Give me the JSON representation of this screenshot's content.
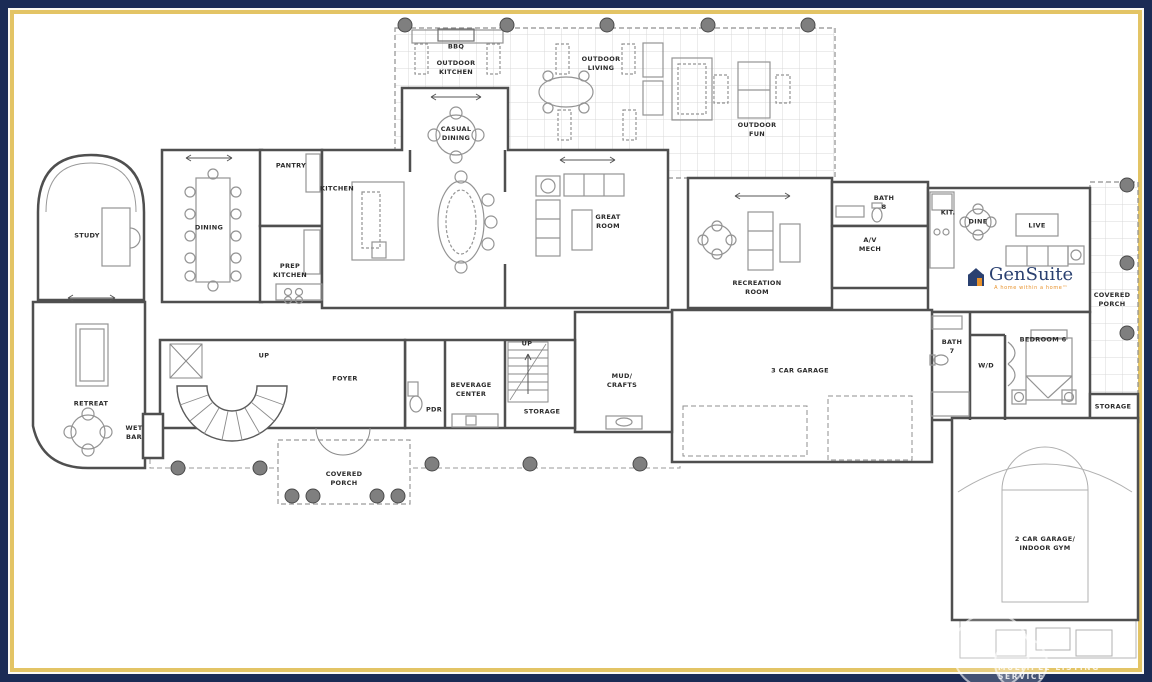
{
  "branding": {
    "logo_text": "GenSuite",
    "logo_tagline": "A home within a home™",
    "watermark": "MULTIPLE LISTING SERVICE"
  },
  "colors": {
    "border_navy": "#1b2c55",
    "border_gold": "#e3c465",
    "wall": "#4f4f4f",
    "furniture": "#949494",
    "logo_blue": "#2a4070",
    "logo_orange": "#e8922c"
  },
  "rooms": [
    {
      "id": "bbq",
      "label": "BBQ",
      "x": 456,
      "y": 47
    },
    {
      "id": "outdoor-kitchen",
      "label": "OUTDOOR\nKITCHEN",
      "x": 456,
      "y": 68
    },
    {
      "id": "outdoor-living",
      "label": "OUTDOOR\nLIVING",
      "x": 601,
      "y": 64
    },
    {
      "id": "outdoor-fun",
      "label": "OUTDOOR\nFUN",
      "x": 757,
      "y": 130
    },
    {
      "id": "casual-dining",
      "label": "CASUAL\nDINING",
      "x": 456,
      "y": 134
    },
    {
      "id": "pantry",
      "label": "PANTRY",
      "x": 291,
      "y": 166
    },
    {
      "id": "kitchen",
      "label": "KITCHEN",
      "x": 337,
      "y": 189
    },
    {
      "id": "dining",
      "label": "DINING",
      "x": 209,
      "y": 228
    },
    {
      "id": "prep-kitchen",
      "label": "PREP\nKITCHEN",
      "x": 290,
      "y": 271
    },
    {
      "id": "study",
      "label": "STUDY",
      "x": 87,
      "y": 236
    },
    {
      "id": "great-room",
      "label": "GREAT\nROOM",
      "x": 608,
      "y": 222
    },
    {
      "id": "recreation-room",
      "label": "RECREATION\nROOM",
      "x": 757,
      "y": 288
    },
    {
      "id": "av-mech",
      "label": "A/V\nMECH",
      "x": 870,
      "y": 245
    },
    {
      "id": "bath-8",
      "label": "BATH\n8",
      "x": 884,
      "y": 203
    },
    {
      "id": "kit",
      "label": "KIT.",
      "x": 948,
      "y": 213
    },
    {
      "id": "dine",
      "label": "DINE",
      "x": 978,
      "y": 222
    },
    {
      "id": "live",
      "label": "LIVE",
      "x": 1037,
      "y": 226
    },
    {
      "id": "covered-porch-right",
      "label": "COVERED\nPORCH",
      "x": 1112,
      "y": 300
    },
    {
      "id": "storage-right",
      "label": "STORAGE",
      "x": 1113,
      "y": 407
    },
    {
      "id": "bedroom-6",
      "label": "BEDROOM 6",
      "x": 1043,
      "y": 340
    },
    {
      "id": "bath-7",
      "label": "BATH\n7",
      "x": 952,
      "y": 347
    },
    {
      "id": "wd-closet",
      "label": "W/D",
      "x": 986,
      "y": 366
    },
    {
      "id": "three-car-garage",
      "label": "3 CAR GARAGE",
      "x": 800,
      "y": 371
    },
    {
      "id": "mud-crafts",
      "label": "MUD/\nCRAFTS",
      "x": 622,
      "y": 381
    },
    {
      "id": "storage-mid",
      "label": "STORAGE",
      "x": 542,
      "y": 412
    },
    {
      "id": "beverage-center",
      "label": "BEVERAGE\nCENTER",
      "x": 471,
      "y": 390
    },
    {
      "id": "pdr",
      "label": "PDR",
      "x": 434,
      "y": 410
    },
    {
      "id": "foyer",
      "label": "FOYER",
      "x": 345,
      "y": 379
    },
    {
      "id": "up-spiral",
      "label": "UP",
      "x": 264,
      "y": 356
    },
    {
      "id": "up-mid",
      "label": "UP",
      "x": 527,
      "y": 344
    },
    {
      "id": "retreat",
      "label": "RETREAT",
      "x": 91,
      "y": 404
    },
    {
      "id": "wet-bar",
      "label": "WET\nBAR",
      "x": 134,
      "y": 433
    },
    {
      "id": "covered-porch-bottom",
      "label": "COVERED\nPORCH",
      "x": 344,
      "y": 479
    },
    {
      "id": "two-car-garage",
      "label": "2 CAR GARAGE/\nINDOOR GYM",
      "x": 1045,
      "y": 544
    }
  ]
}
